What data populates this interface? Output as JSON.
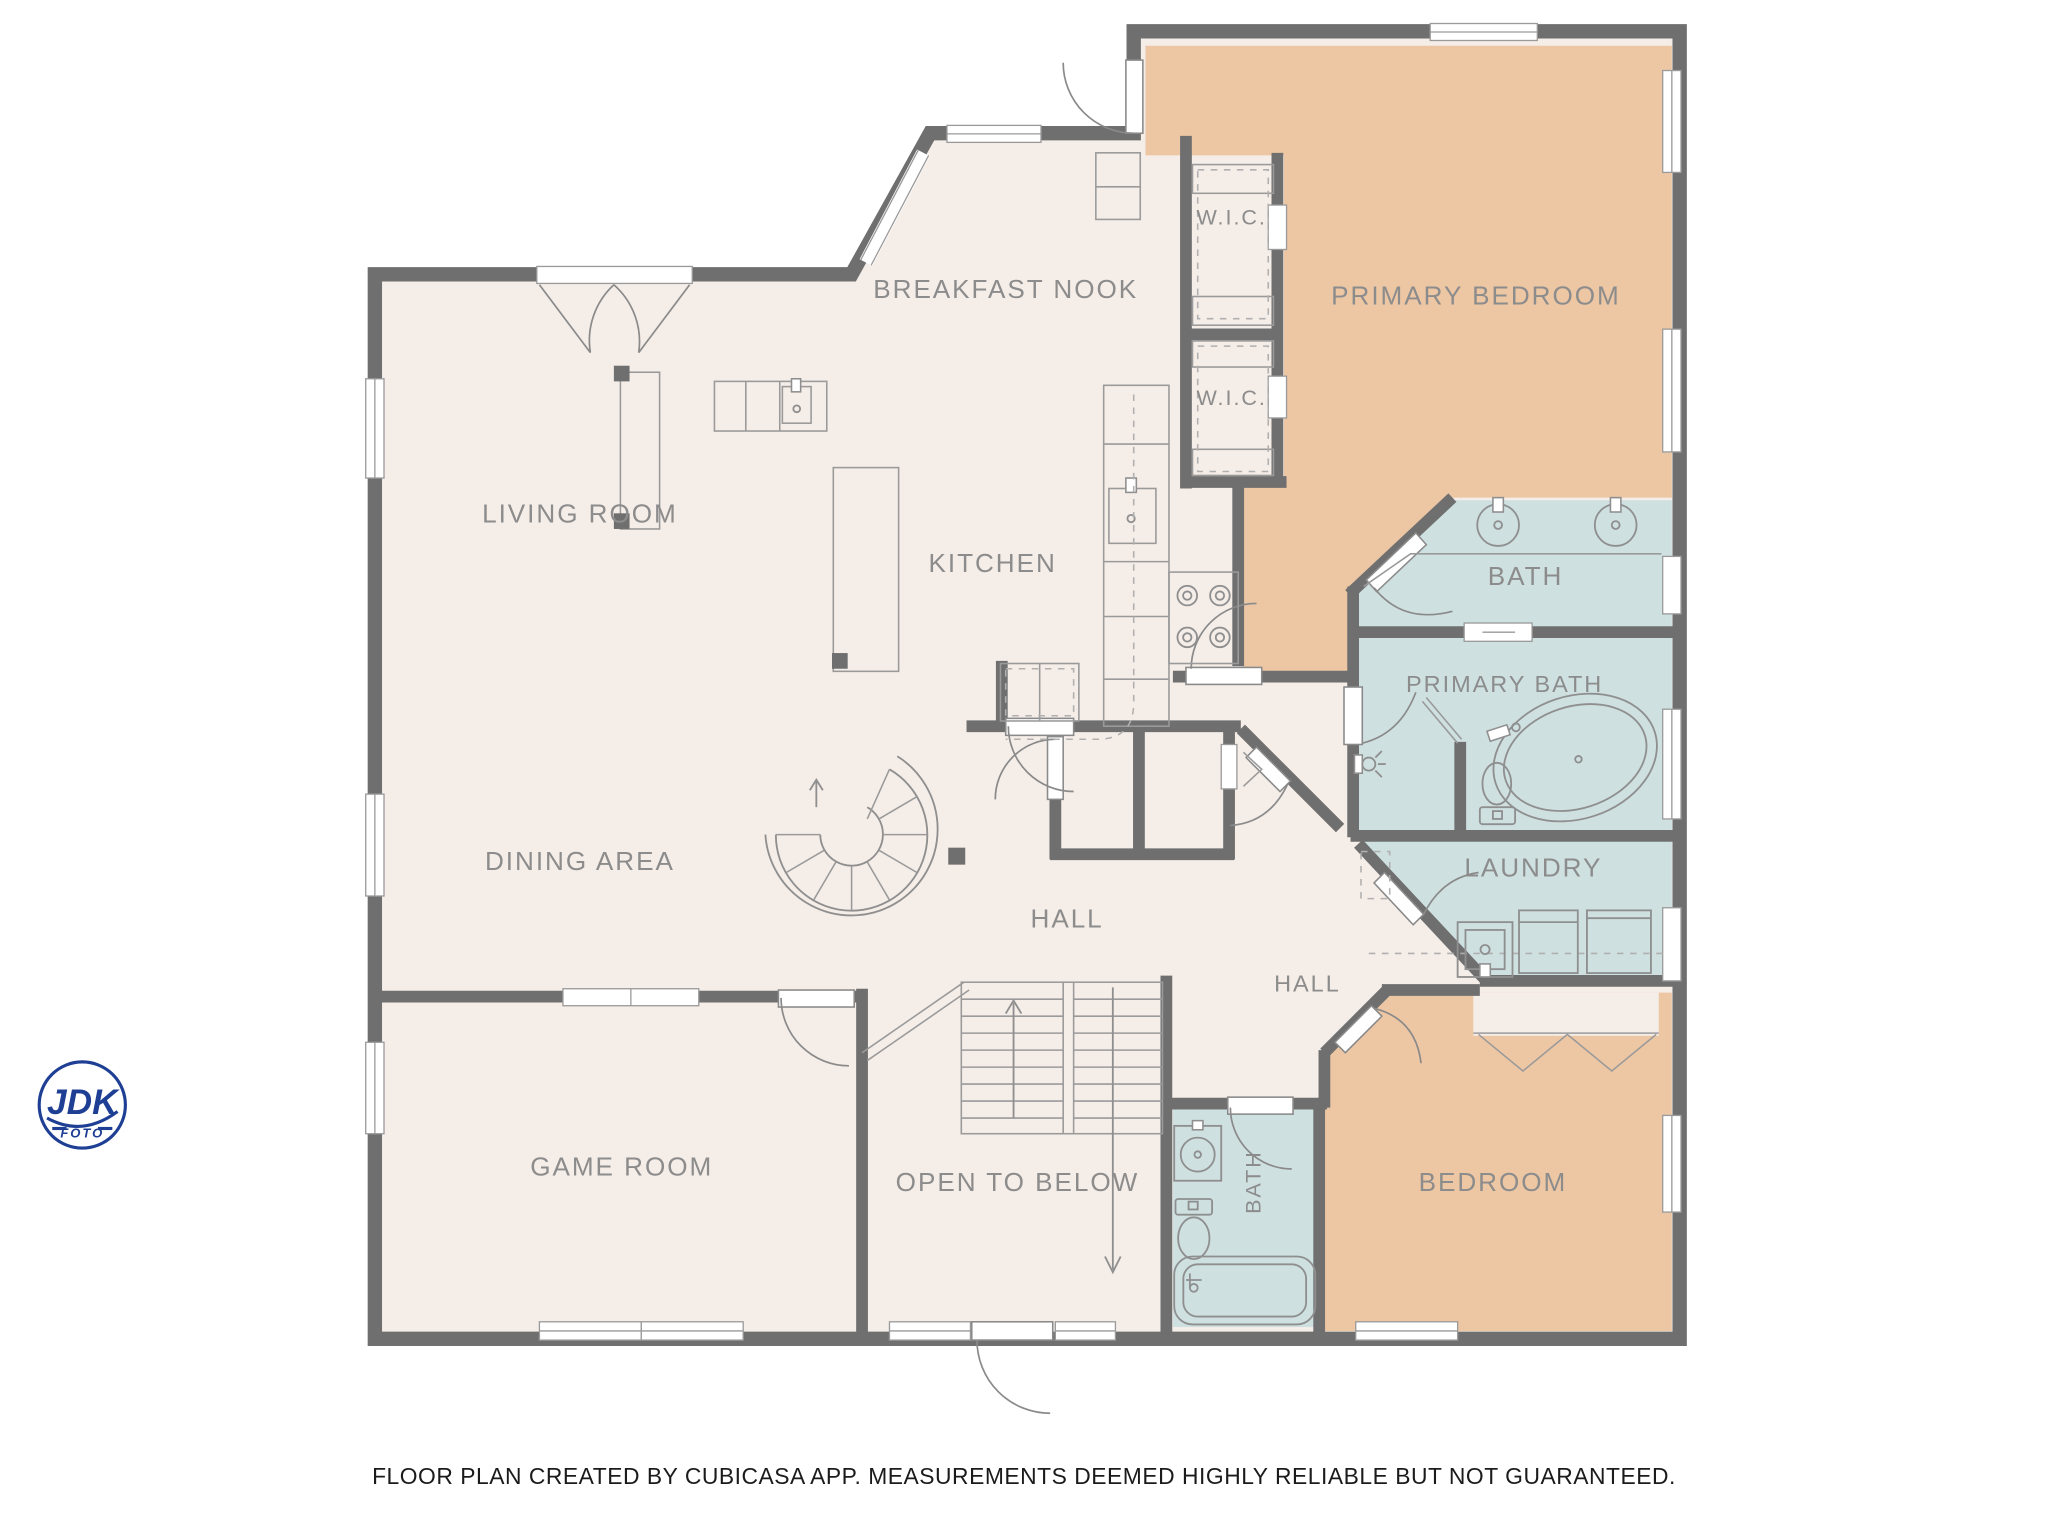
{
  "rooms": [
    {
      "id": "breakfast-nook",
      "label": "BREAKFAST NOOK"
    },
    {
      "id": "primary-bedroom",
      "label": "PRIMARY BEDROOM"
    },
    {
      "id": "wic-1",
      "label": "W.I.C."
    },
    {
      "id": "wic-2",
      "label": "W.I.C."
    },
    {
      "id": "living-room",
      "label": "LIVING ROOM"
    },
    {
      "id": "kitchen",
      "label": "KITCHEN"
    },
    {
      "id": "bath",
      "label": "BATH"
    },
    {
      "id": "primary-bath",
      "label": "PRIMARY BATH"
    },
    {
      "id": "dining-area",
      "label": "DINING AREA"
    },
    {
      "id": "laundry",
      "label": "LAUNDRY"
    },
    {
      "id": "hall",
      "label": "HALL"
    },
    {
      "id": "hall-2",
      "label": "HALL"
    },
    {
      "id": "game-room",
      "label": "GAME ROOM"
    },
    {
      "id": "open-to-below",
      "label": "OPEN TO BELOW"
    },
    {
      "id": "bath-2",
      "label": "BATH"
    },
    {
      "id": "bedroom",
      "label": "BEDROOM"
    }
  ],
  "footer": {
    "disclaimer": "FLOOR PLAN CREATED BY CUBICASA APP. MEASUREMENTS DEEMED HIGHLY RELIABLE BUT NOT GUARANTEED."
  },
  "logo": {
    "line1": "JDK",
    "line2": "FOTO"
  },
  "colors": {
    "wall": "#6f6f6f",
    "floor": "#f5ede8",
    "bedroom_fill": "#edc7a4",
    "bath_fill": "#cfe0e1",
    "label_text": "#8c8c8c",
    "footer_text": "#1b1b1b",
    "logo_blue": "#1e3f94"
  },
  "icons": [
    "spiral-staircase",
    "staircase",
    "up-arrow",
    "down-arrow",
    "stove",
    "kitchen-sink",
    "prep-sink",
    "vanity-sink",
    "toilet",
    "bathtub",
    "oval-tub",
    "shower-head",
    "washer",
    "dryer",
    "laundry-sink",
    "door-swing",
    "window",
    "closet-rod",
    "kitchen-island"
  ]
}
